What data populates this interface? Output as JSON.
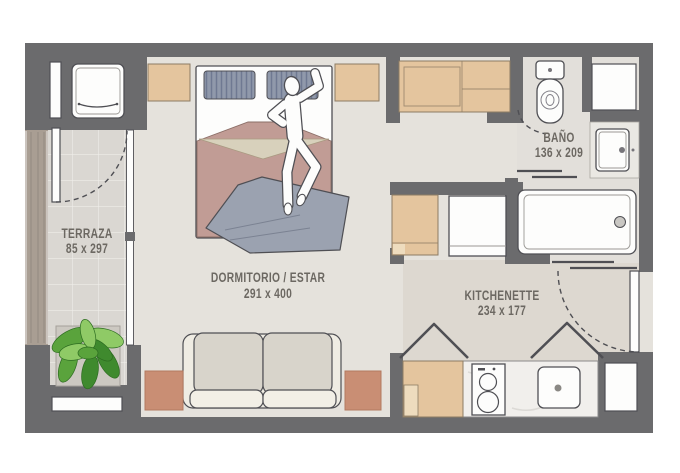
{
  "plan": {
    "rooms": {
      "terraza": {
        "name": "TERRAZA",
        "dims": "85 x 297"
      },
      "dormitorio": {
        "name": "DORMITORIO / ESTAR",
        "dims": "291 x 400"
      },
      "bano": {
        "name": "BAÑO",
        "dims": "136 x 209"
      },
      "kitchenette": {
        "name": "KITCHENETTE",
        "dims": "234 x 177"
      }
    },
    "furniture": [
      "washing-machine",
      "wardrobe",
      "bed",
      "pillows",
      "person",
      "shelf",
      "sofa",
      "side-table",
      "plant",
      "toilet",
      "bathroom-sink",
      "bathtub",
      "refrigerator",
      "closet",
      "kitchen-cabinet",
      "cooktop",
      "kitchen-sink",
      "entry-door",
      "terrace-door",
      "sliding-door",
      "door-swing-arc",
      "window"
    ]
  },
  "colors": {
    "wall": "#6b6b6d",
    "outline": "#4f4f54",
    "floor": "#e5e2dc",
    "floor_terrace": "#dad7d2",
    "floor_kitchen": "#ddd8d0",
    "floor_bath": "#e2dfda",
    "tile_line": "#efede9",
    "wood": "#e4c59e",
    "wood_border": "#8d7c64",
    "wood_light": "#eedcbe",
    "terracotta": "#c98e74",
    "terracotta_border": "#b3795f",
    "sofa_back": "#d8d4cb",
    "sofa_base": "#efece3",
    "sofa_seat": "#f2efe6",
    "bedspread": "#c19c95",
    "bedspread_border": "#8c6f68",
    "bedspread_fold": "#d8d1bc",
    "fold_border": "#a89a80",
    "pillow": "#9099ab",
    "pillow_stripe": "#6f7992",
    "blanket": "#9ba2b0",
    "blanket_line": "#7b8292",
    "plant_green": "#5aa33c",
    "plant_green_dark": "#3f8a2e",
    "plant_green_light": "#8fca66",
    "planter": "#a99e93",
    "planter_line": "#948a80",
    "label": "#6c6862",
    "white": "#fdfdfc",
    "counter": "#f1efec",
    "steel": "#c9c7c3"
  }
}
